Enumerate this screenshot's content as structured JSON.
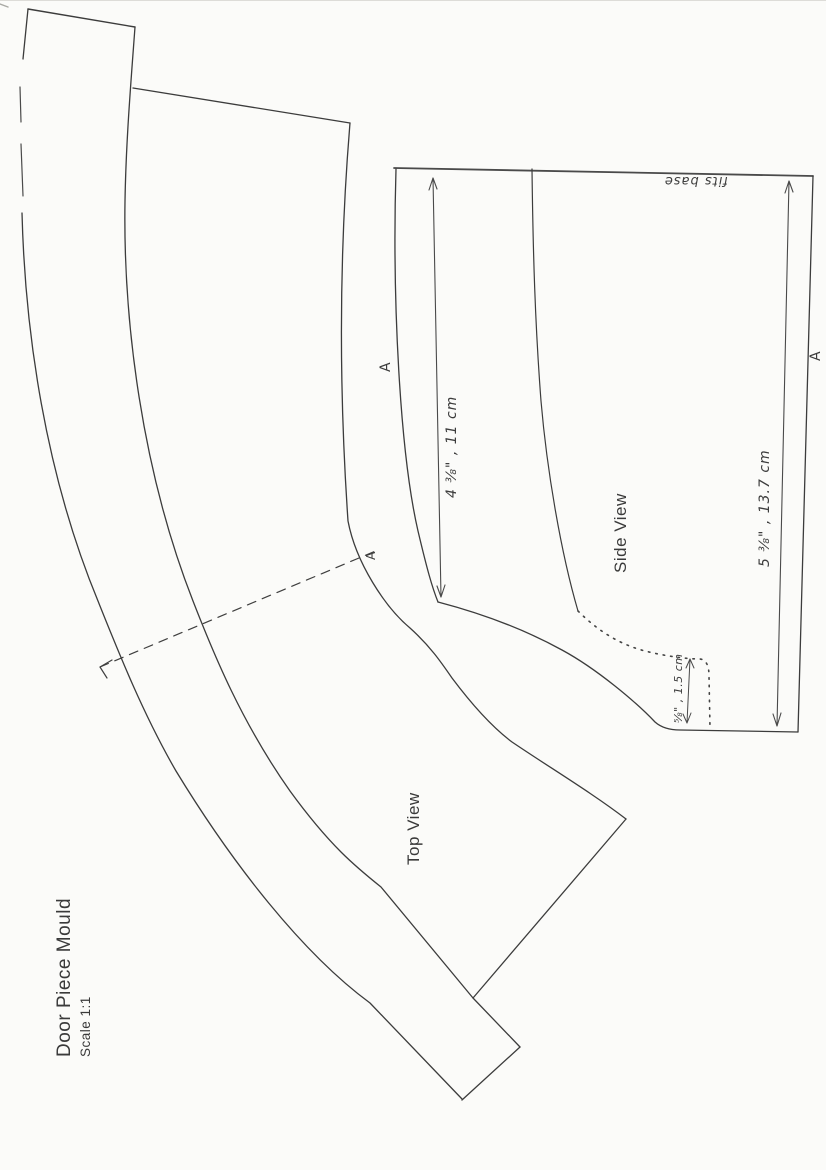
{
  "document": {
    "title": "Door Piece Mould",
    "scale_note": "Scale 1:1"
  },
  "colors": {
    "paper": "#fbfbf9",
    "ink": "#3c3c3c",
    "pencil": "#555555"
  },
  "views": {
    "top": {
      "label": "Top View"
    },
    "side": {
      "label": "Side View"
    }
  },
  "dimensions": {
    "side_height_left": "4 ⅜\" , 11 cm",
    "side_height_right": "5 ⅜\" , 13.7 cm",
    "base_step": "⅝\" , 1.5 cm"
  },
  "notes": {
    "base_note": "fits base"
  },
  "section_labels": {
    "section_arrow_a": "A",
    "side_left_a": "A",
    "side_right_a": "A"
  }
}
